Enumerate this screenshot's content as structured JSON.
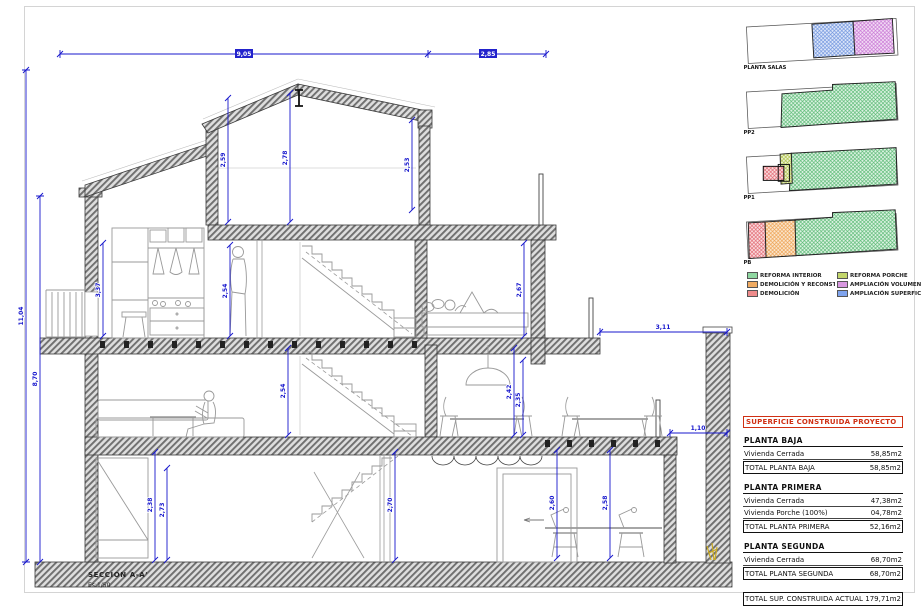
{
  "sheet": {
    "title": "SECCION A-A'",
    "scale": "Es:1/50"
  },
  "colors": {
    "accent_red": "#d03014",
    "dim_blue": "#1717cd",
    "wall_gray": "#707070"
  },
  "dims": {
    "top_main": "9,05",
    "top_right": "2,85",
    "total_height": "11,04",
    "eave_height": "8,70",
    "attic_left": "2,59",
    "attic_ridge": "2,78",
    "attic_right": "2,53",
    "p2_left": "3,37",
    "p2_mid": "2,54",
    "p2_right": "2,67",
    "p1_left": "2,54",
    "p1_mid": "2,42",
    "p1_mid2": "2,35",
    "pb_a": "2,38",
    "pb_b": "2,73",
    "pb_c": "2,70",
    "pb_d": "2,60",
    "pb_e": "2,58",
    "right_upper": "3,11",
    "right_lower": "1,10"
  },
  "miniplans": [
    {
      "label": "PLANTA SALAS"
    },
    {
      "label": "PP2"
    },
    {
      "label": "PP1"
    },
    {
      "label": "PB"
    }
  ],
  "legend": [
    {
      "label": "REFORMA INTERIOR",
      "color": "#8fd7a1"
    },
    {
      "label": "REFORMA PORCHE",
      "color": "#c3d66b"
    },
    {
      "label": "DEMOLICIÓN Y RECONSTRUCCIÓN",
      "color": "#f0ab62"
    },
    {
      "label": "AMPLIACIÓN VOLUMEN",
      "color": "#d897e0"
    },
    {
      "label": "DEMOLICIÓN",
      "color": "#ee8b8b"
    },
    {
      "label": "AMPLIACIÓN SUPERFICIE",
      "color": "#7fa4ee"
    }
  ],
  "areas_table": {
    "header": "SUPERFICIE CONSTRUIDA PROYECTO",
    "sections": [
      {
        "title": "PLANTA BAJA",
        "rows": [
          [
            "Vivienda Cerrada",
            "58,85m2"
          ]
        ],
        "total": [
          "TOTAL PLANTA BAJA",
          "58,85m2"
        ]
      },
      {
        "title": "PLANTA PRIMERA",
        "rows": [
          [
            "Vivienda Cerrada",
            "47,38m2"
          ],
          [
            "Vivienda Porche (100%)",
            "04,78m2"
          ]
        ],
        "total": [
          "TOTAL PLANTA PRIMERA",
          "52,16m2"
        ]
      },
      {
        "title": "PLANTA SEGUNDA",
        "rows": [
          [
            "Vivienda Cerrada",
            "68,70m2"
          ]
        ],
        "total": [
          "TOTAL PLANTA SEGUNDA",
          "68,70m2"
        ]
      }
    ],
    "grand_total": [
      "TOTAL SUP. CONSTRUIDA ACTUAL",
      "179,71m2"
    ]
  }
}
